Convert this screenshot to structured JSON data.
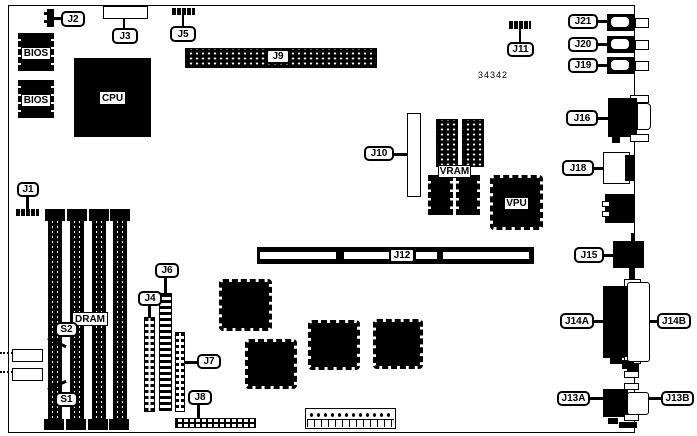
{
  "diagram": {
    "part_number": "34342",
    "ink_color": "#000000",
    "background_color": "#ffffff"
  },
  "chips": {
    "bios_top": "BIOS",
    "bios_bottom": "BIOS",
    "cpu": "CPU",
    "dram": "DRAM",
    "vram": "VRAM",
    "vpu": "VPU"
  },
  "connectors": {
    "j1": "J1",
    "j2": "J2",
    "j3": "J3",
    "j4": "J4",
    "j5": "J5",
    "j6": "J6",
    "j7": "J7",
    "j8": "J8",
    "j9": "J9",
    "j10": "J10",
    "j11": "J11",
    "j12": "J12",
    "j13a": "J13A",
    "j13b": "J13B",
    "j14a": "J14A",
    "j14b": "J14B",
    "j15": "J15",
    "j16": "J16",
    "j18": "J18",
    "j19": "J19",
    "j20": "J20",
    "j21": "J21",
    "s1": "S1",
    "s2": "S2"
  }
}
